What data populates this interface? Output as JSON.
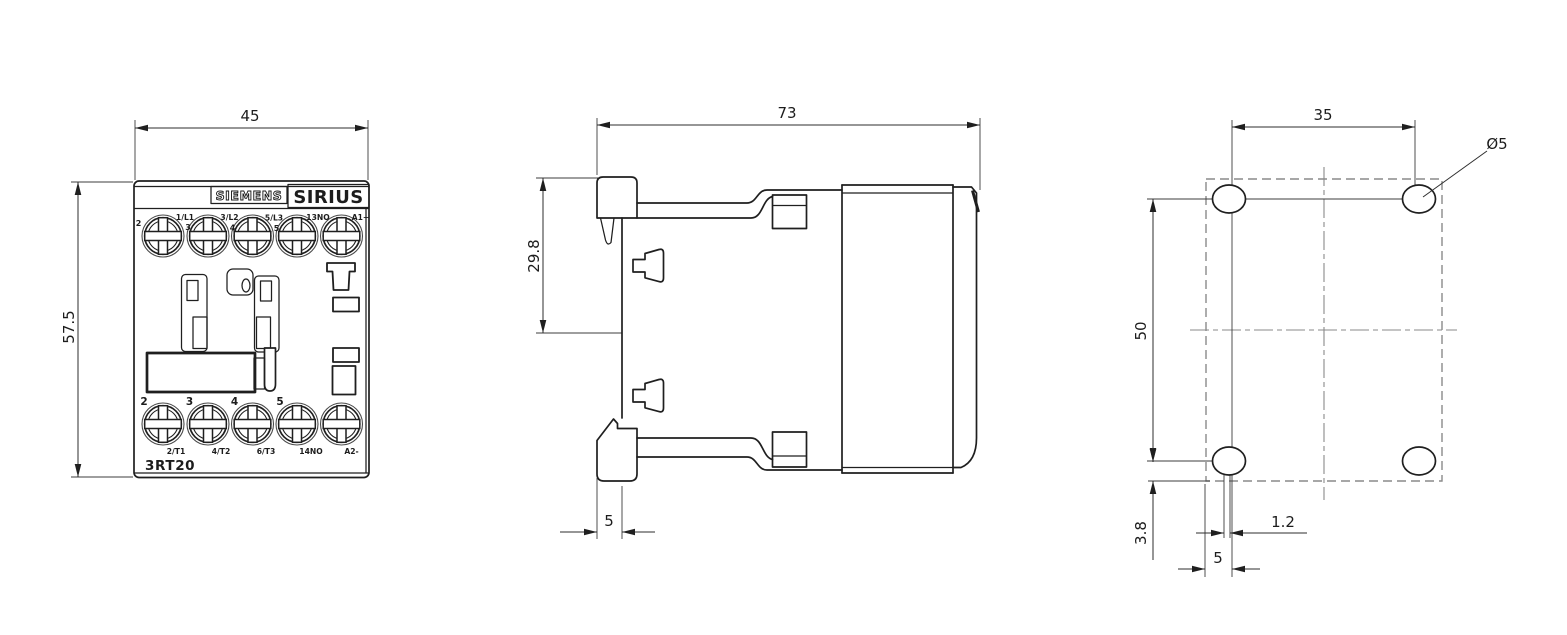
{
  "title": "Siemens SIRIUS 3RT20 contactor dimensional drawing",
  "colors": {
    "line": "#1f1f1f",
    "dimension": "#2e2e2e",
    "construction": "#8a8a8a",
    "background": "#ffffff"
  },
  "front_view": {
    "dim_width": "45",
    "dim_height": "57.5",
    "brand_label": "SIEMENS",
    "series_label": "SIRIUS",
    "model_label": "3RT20",
    "top_pole_numbers": [
      "2",
      "3",
      "4",
      "5"
    ],
    "top_terminals": [
      "1/L1",
      "3/L2",
      "5/L3",
      "13NO",
      "A1+"
    ],
    "bottom_pole_numbers": [
      "2",
      "3",
      "4",
      "5"
    ],
    "bottom_terminals": [
      "2/T1",
      "4/T2",
      "6/T3",
      "14NO",
      "A2-"
    ]
  },
  "side_view": {
    "dim_depth": "73",
    "dim_top_to_catch": "29.8",
    "dim_hook_depth": "5"
  },
  "drill_plan": {
    "dim_hole_spacing_horizontal": "35",
    "dim_hole_spacing_vertical": "50",
    "hole_diameter_label": "Ø5",
    "dim_hole_to_bottom_edge": "3.8",
    "dim_slot_width": "1.2",
    "dim_edge_to_hole": "5"
  }
}
